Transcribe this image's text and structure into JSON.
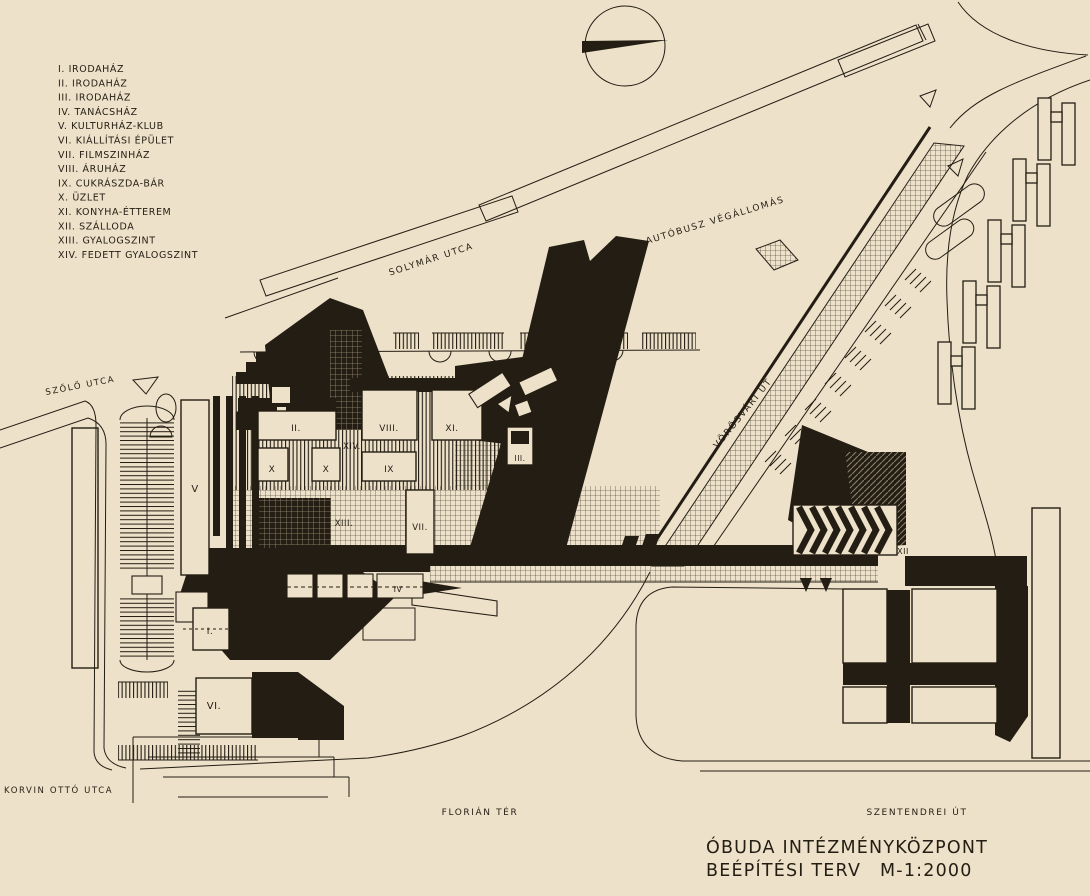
{
  "canvas": {
    "paper_color": "#EDE1C9",
    "ink_color": "#241D13"
  },
  "legend": {
    "items": [
      "I. IRODAHÁZ",
      "II. IRODAHÁZ",
      "III. IRODAHÁZ",
      "IV. TANÁCSHÁZ",
      "V. KULTURHÁZ-KLUB",
      "VI. KIÁLLÍTÁSI ÉPÜLET",
      "VII. FILMSZINHÁZ",
      "VIII. ÁRUHÁZ",
      "IX. CUKRÁSZDA-BÁR",
      "X. ÜZLET",
      "XI. KONYHA-ÉTTEREM",
      "XII. SZÁLLODA",
      "XIII. GYALOGSZINT",
      "XIV. FEDETT GYALOGSZINT"
    ]
  },
  "streets": {
    "solymar": "SOLYMÁR UTCA",
    "autobusz": "AUTÓBUSZ VÉGÁLLOMÁS",
    "vorosvari": "VÖRÖSVÁRI ÚT",
    "szolo": "SZŐLŐ UTCA",
    "korvin": "KORVIN OTTÓ UTCA",
    "florian": "FLORIÁN TÉR",
    "szentendrei": "SZENTENDREI ÚT"
  },
  "plan_labels": {
    "l_I": "I.",
    "l_II": "II.",
    "l_III": "III.",
    "l_IV": "IV",
    "l_V": "V",
    "l_VI": "VI.",
    "l_VII": "VII.",
    "l_VIII": "VIII.",
    "l_IX": "IX",
    "l_X1": "X",
    "l_X2": "X",
    "l_XI": "XI.",
    "l_XII_plaza": "XII",
    "l_XII_hotel": "XII",
    "l_XIII": "XIII.",
    "l_XIV": "XIV."
  },
  "title": {
    "line1": "ÓBUDA INTÉZMÉNYKÖZPONT",
    "line2": "BEÉPÍTÉSI TERV",
    "scale": "M-1:2000"
  }
}
